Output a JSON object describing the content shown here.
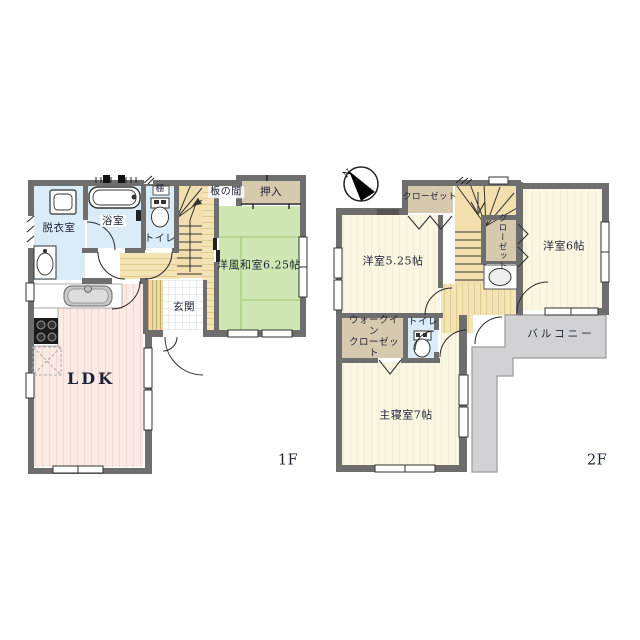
{
  "floor1": {
    "label": "1F",
    "dressing": "脱衣室",
    "bath": "浴室",
    "shelf": "棚",
    "toilet": "トイレ",
    "itanoma": "板の間",
    "oshiire": "押入",
    "washitsu": "洋風和室6.25帖",
    "genkan": "玄関",
    "ldk": "LDK"
  },
  "floor2": {
    "label": "2F",
    "closet_top": "クローゼット",
    "closet_mid": "クローゼット",
    "room525": "洋室5.25帖",
    "room6": "洋室6帖",
    "toilet": "トイレ",
    "wic_line1": "ウォークイン",
    "wic_line2": "クローゼット",
    "balcony": "バルコニー",
    "master": "主寝室7帖"
  },
  "compass": {
    "north": "N"
  },
  "colors": {
    "wall": "#6e6e6e",
    "water_blue": "#d9ecf7",
    "tatami_green": "#cfe7b2",
    "wood_beige": "#f2dfad",
    "closet_tan": "#d6c9ad",
    "ldk_pink": "#fcebe5",
    "room_ivory": "#faf6e2",
    "balcony_gray": "#d2d2d4",
    "entry_checker": "#ffffff"
  }
}
